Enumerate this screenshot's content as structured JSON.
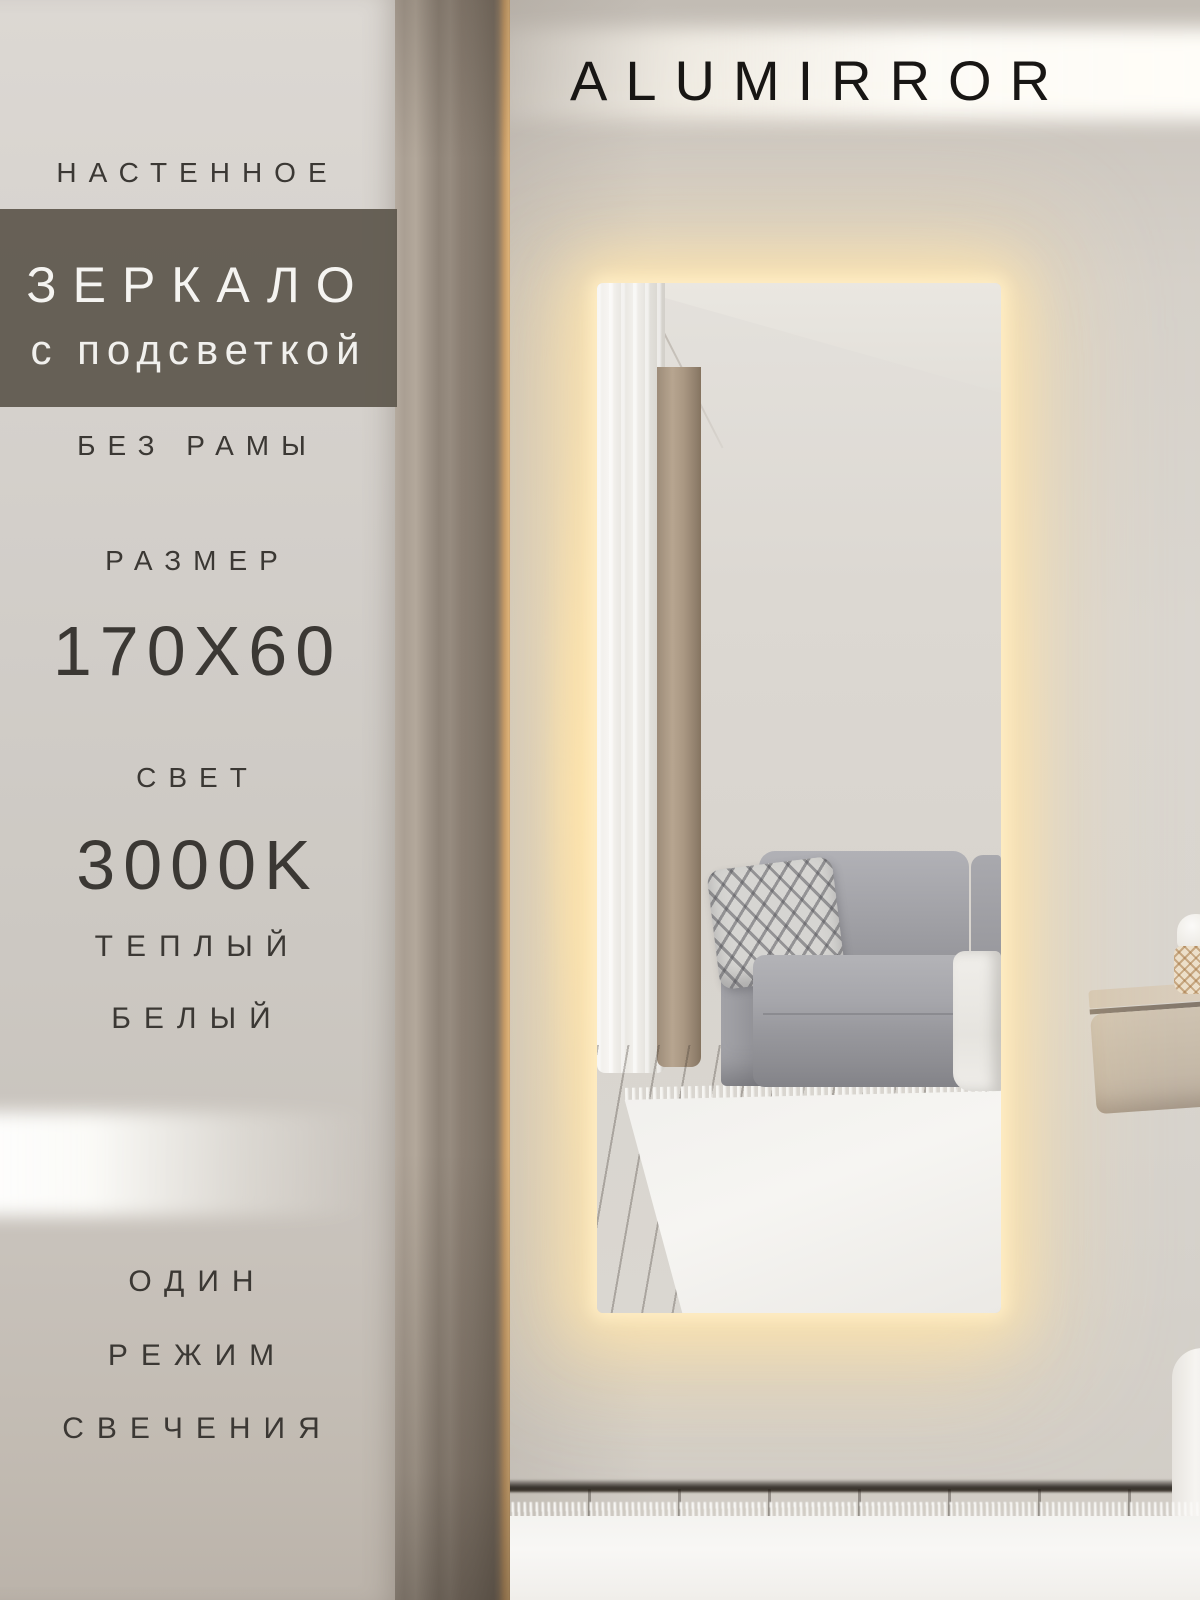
{
  "brand": "ALUMIRROR",
  "panel": {
    "mount_type": "НАСТЕННОЕ",
    "product_title": "ЗЕРКАЛО",
    "product_subtitle": "с подсветкой",
    "frame": "БЕЗ РАМЫ",
    "size_label": "РАЗМЕР",
    "size_value": "170X60",
    "light_label": "СВЕТ",
    "light_temperature": "3000K",
    "light_tone_line1": "ТЕПЛЫЙ",
    "light_tone_line2": "БЕЛЫЙ",
    "mode_line1": "ОДИН",
    "mode_line2": "РЕЖИМ",
    "mode_line3": "СВЕЧЕНИЯ"
  },
  "colors": {
    "led_glow": "#ffe9c0",
    "overlay_band": "#6b6459",
    "panel_text": "#3b3834",
    "brand_text": "#181614",
    "panel_background": "#d2cec9"
  }
}
